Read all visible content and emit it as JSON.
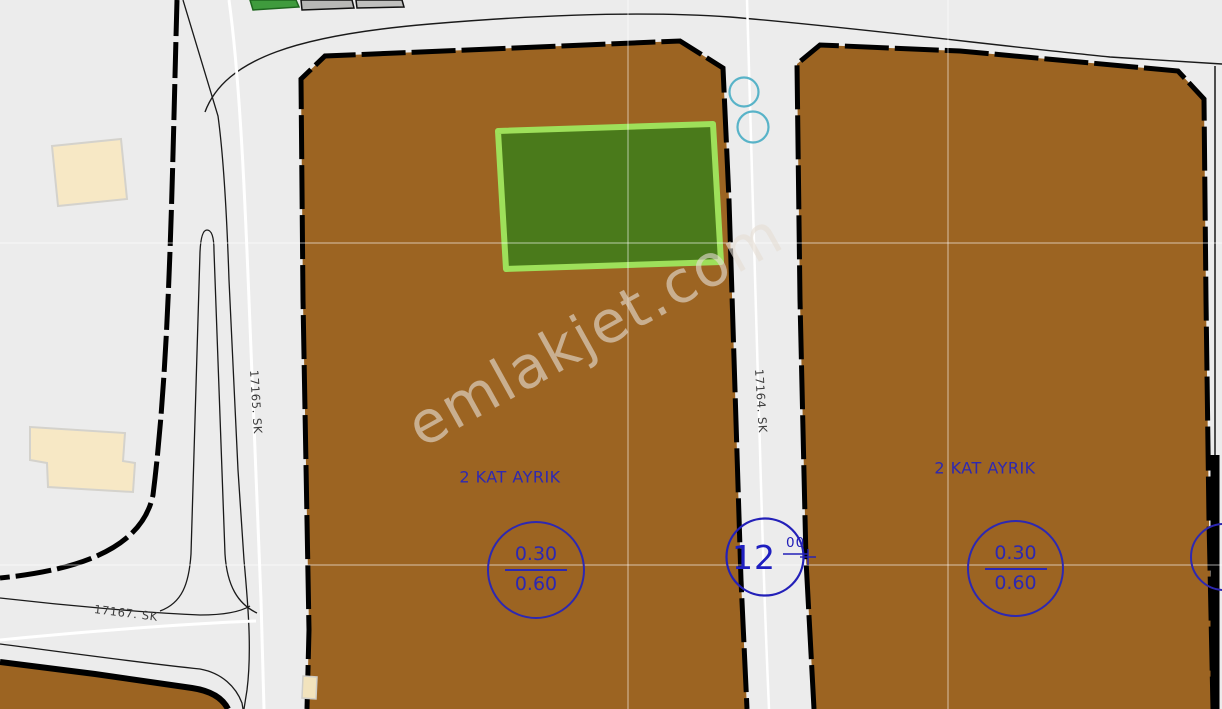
{
  "watermark": "emlakjet.com",
  "streets": {
    "left": "17165. SK",
    "center": "17164. SK",
    "bottom": "17167. SK"
  },
  "zoning": {
    "left_label": "2 KAT AYRIK",
    "right_label": "2 KAT AYRIK"
  },
  "ratios": {
    "left": {
      "num": "0.30",
      "den": "0.60"
    },
    "right": {
      "num": "0.30",
      "den": "0.60"
    }
  },
  "block": {
    "number": "12",
    "fraction_num": "00"
  },
  "colors": {
    "road_gray": "#ececec",
    "parcel_brown": "#9c6422",
    "highlight_fill": "#4a7a1b",
    "highlight_border": "#9ee05a",
    "annotation_blue": "#2d28b2",
    "survey_teal": "#58b3c8",
    "building_beige": "#f7e8c5",
    "boundary_black": "#000000"
  }
}
